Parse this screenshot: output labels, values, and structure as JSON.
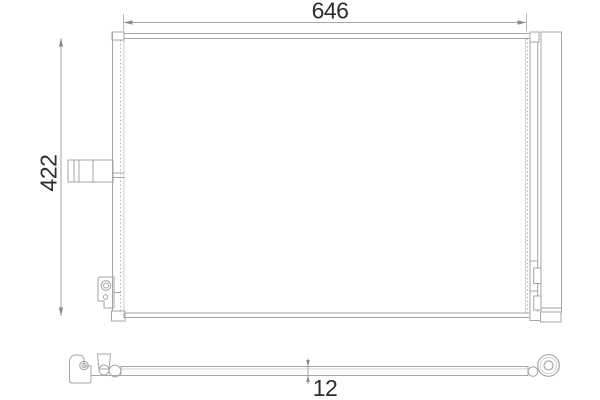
{
  "drawing": {
    "dimension_labels": {
      "width": "646",
      "height": "422",
      "depth": "12"
    },
    "colors": {
      "line": "#a6a6a6",
      "line_dark": "#8a8a8a",
      "text": "#2d2d2d",
      "background": "#ffffff"
    }
  }
}
